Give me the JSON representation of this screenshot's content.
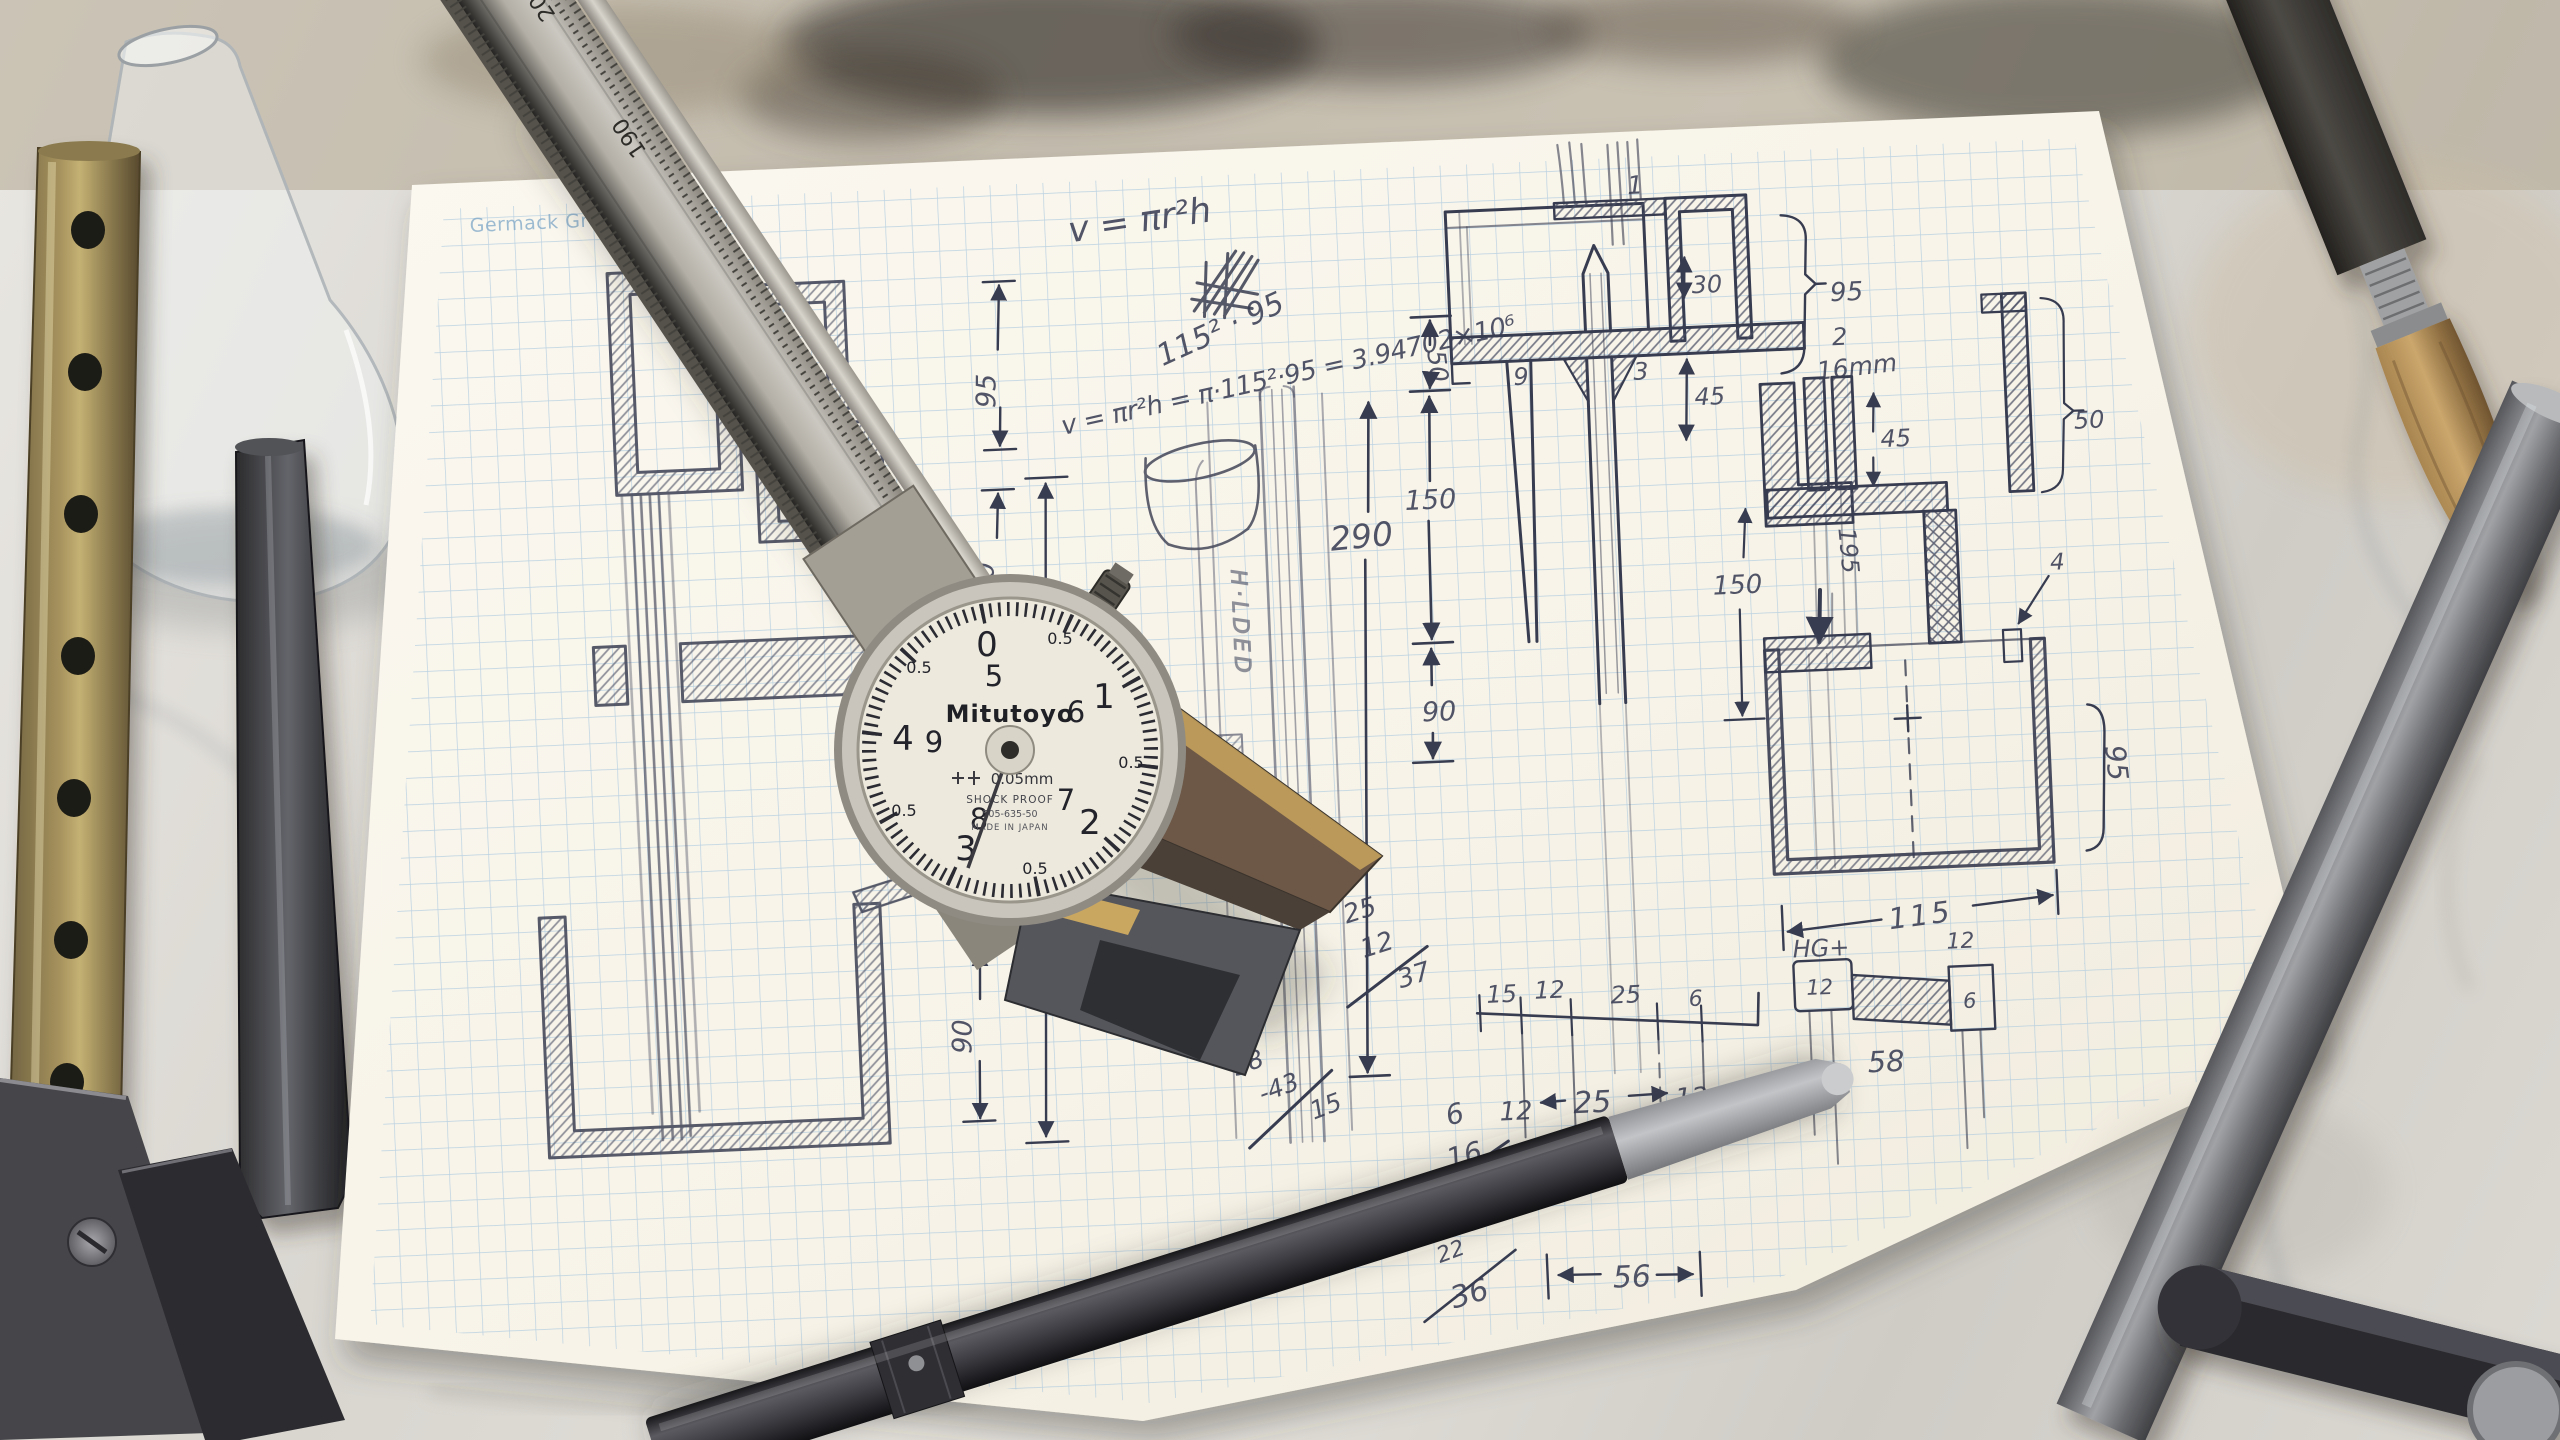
{
  "scene": {
    "title": "Hand-drawn engineering sketch on graph paper with dial caliper and metal tools on a marble workbench"
  },
  "paper": {
    "header": "Germack Graph Papers ®",
    "formula_top": "v = πr²h",
    "calc_power": "115² · 95",
    "calc_main": "v = πr²h = π·115²·95 = 3.94702×10⁶",
    "note_vertical": "H·LDED",
    "labels": {
      "part1": "1",
      "part2": "2",
      "part3": "3",
      "part9": "9",
      "part4": "4"
    },
    "dims": {
      "left_95": "95",
      "left_50": "50",
      "left_90": "90",
      "mid_290": "290",
      "mid_50": "50",
      "mid_150": "150",
      "mid_90": "90",
      "piston_30": "30",
      "piston_45": "45",
      "piston_wall_95": "95",
      "right_16mm": "16mm",
      "right_45": "45",
      "right_195": "195",
      "right_50": "50",
      "right_150": "150",
      "box_115": "115",
      "box_95": "95",
      "hg": "HG+",
      "cell_12a": "12",
      "cell_12b": "12",
      "cell_6": "6",
      "under_58": "58",
      "row": [
        "15",
        "12",
        "25",
        "6"
      ],
      "row2_left": "12",
      "row2_mid": "25",
      "row2_right": "12",
      "dim_56": "56"
    },
    "sums": {
      "sum1_a": "25",
      "sum1_b": "12",
      "sum1_r": "37",
      "sum2_a": "58",
      "sum2_b": "-43",
      "sum2_r": "15",
      "sum3_a": "6",
      "sum3_r": "16",
      "sum4_a": "22",
      "sum4_r": "36"
    }
  },
  "caliper": {
    "brand": "Mitutoyo",
    "precision": "0.05mm",
    "shockproof": "SHOCK PROOF",
    "model": "505-635-50",
    "origin": "MADE IN JAPAN",
    "dial": {
      "outer": [
        "0",
        "1",
        "2",
        "3",
        "4"
      ],
      "inner": [
        "5",
        "6",
        "7",
        "8",
        "9"
      ],
      "half": "0.5"
    },
    "beam_numbers": [
      "200",
      "190"
    ]
  }
}
